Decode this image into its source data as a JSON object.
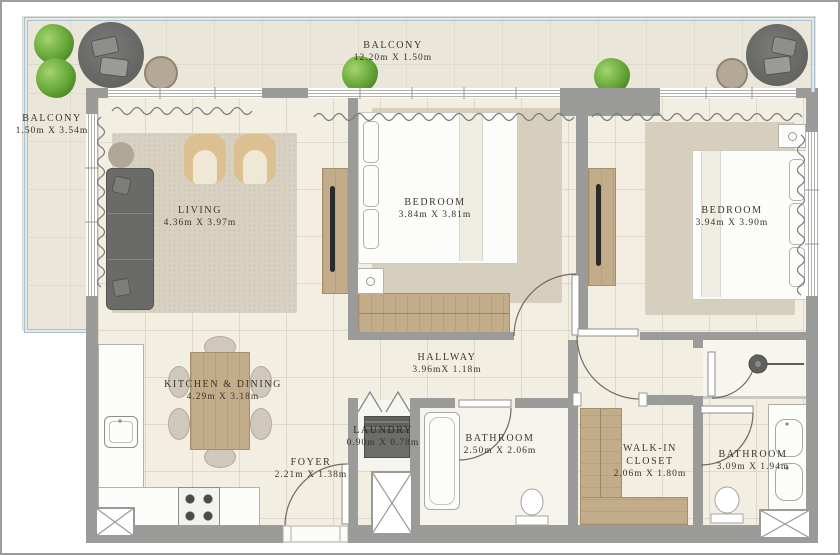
{
  "rooms": [
    {
      "id": "balcony-top",
      "name": "BALCONY",
      "dims": "12.20m X 1.50m"
    },
    {
      "id": "balcony-left",
      "name": "BALCONY",
      "dims": "1.50m X 3.54m"
    },
    {
      "id": "living",
      "name": "LIVING",
      "dims": "4.36m X 3.97m"
    },
    {
      "id": "bedroom-1",
      "name": "BEDROOM",
      "dims": "3.84m X 3.81m"
    },
    {
      "id": "bedroom-2",
      "name": "BEDROOM",
      "dims": "3.94m X 3.90m"
    },
    {
      "id": "kitchen-dining",
      "name": "KITCHEN & DINING",
      "dims": "4.29m X 3.18m"
    },
    {
      "id": "hallway",
      "name": "HALLWAY",
      "dims": "3.96mX 1.18m"
    },
    {
      "id": "laundry",
      "name": "LAUNDRY",
      "dims": "0.90m X 0.78m"
    },
    {
      "id": "foyer",
      "name": "FOYER",
      "dims": "2.21m X 1.38m"
    },
    {
      "id": "bathroom-1",
      "name": "BATHROOM",
      "dims": "2.50m X 2.06m"
    },
    {
      "id": "walk-in-closet",
      "name": "WALK-IN CLOSET",
      "dims": "2.06m X 1.80m"
    },
    {
      "id": "bathroom-2",
      "name": "BATHROOM",
      "dims": "3.09m X 1.94m"
    }
  ],
  "colors": {
    "wall": "#9b9b99",
    "floor": "#f3eee2",
    "balcony_floor": "#ebe6da",
    "wood": "#c3ac8a",
    "railing": "#abc1cf",
    "rug": "#d8d1c1",
    "text": "#3b342a",
    "dark_furniture": "#6a6a68",
    "plant": "#5f9e35"
  }
}
